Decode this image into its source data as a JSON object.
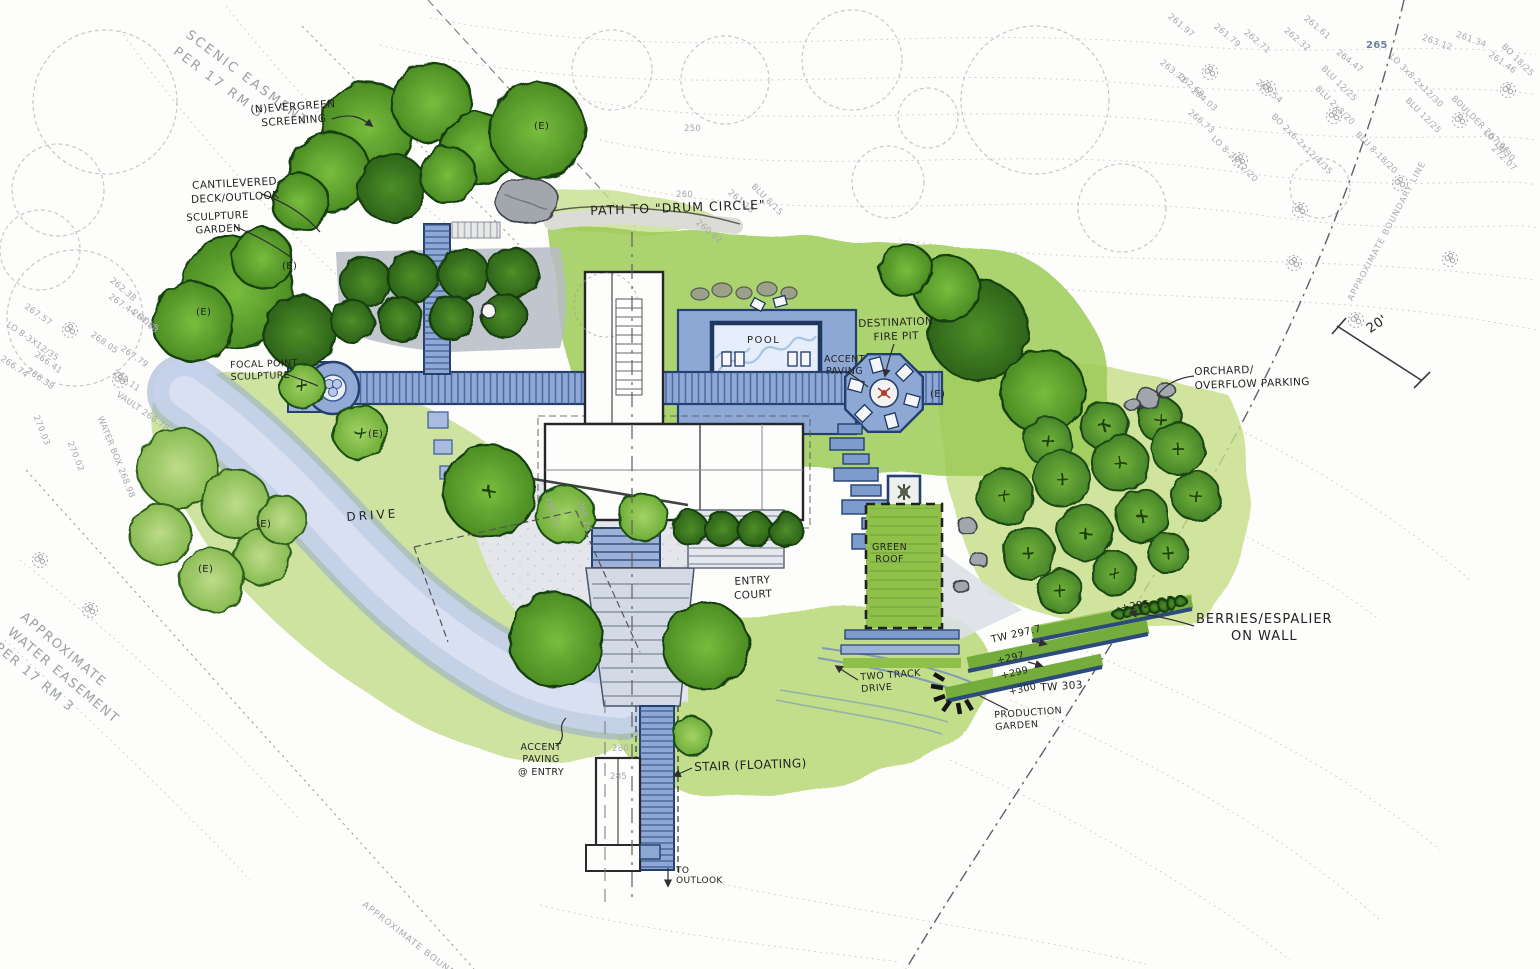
{
  "meta": {
    "drawing_type": "residential landscape site plan, hand-rendered",
    "scale_label": "20'"
  },
  "colors": {
    "paper": "#fdfdfb",
    "canopy_dark": "#2f6b25",
    "canopy_medium": "#57972c",
    "canopy_light": "#7ab344",
    "lawn": "#9ccb55",
    "groundcover": "#c6de8e",
    "paving_blue": "#8ea8d6",
    "drive_blue": "#c7d3ec",
    "pool_water": "#e5eefa",
    "outline_blue": "#23406e",
    "survey_gray": "#a6a9ad",
    "ink": "#232323",
    "fire_accent": "#b43a2e"
  },
  "labels": {
    "scenic_easement": "SCENIC EASMENT\nPER 17 RM 3",
    "evergreen_screening": "(N)EVERGREEN\nSCREENING",
    "cantilevered_deck": "CANTILEVERED\nDECK/OUTLOOK",
    "sculpture_garden": "SCULPTURE\nGARDEN",
    "path_drum_circle": "PATH TO \"DRUM CIRCLE\"",
    "pool": "POOL",
    "destination_fire_pit": "DESTINATION\nFIRE PIT",
    "accent_paving": "ACCENT\nPAVING",
    "orchard_overflow": "ORCHARD/\nOVERFLOW PARKING",
    "focal_point": "FOCAL POINT\nSCULPTURE",
    "drive": "DRIVE",
    "entry_court": "ENTRY\nCOURT",
    "green_roof": "GREEN\nROOF",
    "berries_espalier": "BERRIES/ESPALIER\nON WALL",
    "production_garden": "PRODUCTION\nGARDEN",
    "two_track_drive": "TWO TRACK\nDRIVE",
    "accent_paving_entry": "ACCENT\nPAVING\n@ ENTRY",
    "stair_floating": "STAIR (FLOATING)",
    "to_outlook": "TO\nOUTLOOK",
    "water_easement": "APPROXIMATE\nWATER EASEMENT\nPER 17 RM 3",
    "boundary_line": "APPROXIMATE BOUNDARY LINE",
    "boundary": "APPROXIMATE BOUNDARY",
    "scale": "20'",
    "existing_tree_tag": "(E)",
    "elevations": {
      "p295": "+295",
      "tw297": "TW 297.7",
      "p297": "+297",
      "p299": "+299",
      "p300": "+300",
      "tw303": "TW 303"
    }
  },
  "survey_marks": [
    {
      "text": "261.97",
      "x": 1172,
      "y": 12,
      "rot": 40
    },
    {
      "text": "261.79",
      "x": 1218,
      "y": 22,
      "rot": 40
    },
    {
      "text": "262.71",
      "x": 1248,
      "y": 28,
      "rot": 40
    },
    {
      "text": "262.32",
      "x": 1288,
      "y": 26,
      "rot": 40
    },
    {
      "text": "261.61",
      "x": 1308,
      "y": 14,
      "rot": 40
    },
    {
      "text": "264.47",
      "x": 1340,
      "y": 48,
      "rot": 38
    },
    {
      "text": "265",
      "x": 1366,
      "y": 40,
      "rot": 0,
      "cls": "em"
    },
    {
      "text": "263.12",
      "x": 1424,
      "y": 33,
      "rot": 20
    },
    {
      "text": "261.34",
      "x": 1458,
      "y": 30,
      "rot": 20
    },
    {
      "text": "261.46",
      "x": 1492,
      "y": 50,
      "rot": 35
    },
    {
      "text": "BO 18/25",
      "x": 1506,
      "y": 42,
      "rot": 45
    },
    {
      "text": "262.69",
      "x": 1182,
      "y": 72,
      "rot": 40
    },
    {
      "text": "263.71",
      "x": 1164,
      "y": 58,
      "rot": 40
    },
    {
      "text": "265.54",
      "x": 1260,
      "y": 78,
      "rot": 40
    },
    {
      "text": "264.03",
      "x": 1195,
      "y": 86,
      "rot": 40
    },
    {
      "text": "266.73",
      "x": 1192,
      "y": 108,
      "rot": 40
    },
    {
      "text": "BLU 12/25",
      "x": 1326,
      "y": 64,
      "rot": 45
    },
    {
      "text": "BLU 2x8/20",
      "x": 1320,
      "y": 84,
      "rot": 45
    },
    {
      "text": "LO 3x8-2x12/30",
      "x": 1394,
      "y": 52,
      "rot": 45
    },
    {
      "text": "BLU 12/25",
      "x": 1410,
      "y": 96,
      "rot": 45
    },
    {
      "text": "BOULDER 267.96",
      "x": 1456,
      "y": 94,
      "rot": 45
    },
    {
      "text": "BO 2x6-2x12/4/35",
      "x": 1276,
      "y": 112,
      "rot": 45
    },
    {
      "text": "BLU 8-18/20",
      "x": 1360,
      "y": 130,
      "rot": 45
    },
    {
      "text": "LO 19/30",
      "x": 1488,
      "y": 128,
      "rot": 45
    },
    {
      "text": "272.07",
      "x": 1496,
      "y": 144,
      "rot": 45
    },
    {
      "text": "LO 8-2X12/20",
      "x": 1216,
      "y": 134,
      "rot": 45
    },
    {
      "text": "267.57",
      "x": 28,
      "y": 302,
      "rot": 35
    },
    {
      "text": "LO 8-3X12/35",
      "x": 10,
      "y": 320,
      "rot": 35
    },
    {
      "text": "266.74",
      "x": 4,
      "y": 354,
      "rot": 35
    },
    {
      "text": "266.41",
      "x": 38,
      "y": 350,
      "rot": 35
    },
    {
      "text": "266.38",
      "x": 30,
      "y": 366,
      "rot": 35
    },
    {
      "text": "267.44 HOLE",
      "x": 112,
      "y": 292,
      "rot": 35
    },
    {
      "text": "267.83",
      "x": 136,
      "y": 308,
      "rot": 40
    },
    {
      "text": "262.38",
      "x": 114,
      "y": 276,
      "rot": 40
    },
    {
      "text": "268.05",
      "x": 94,
      "y": 330,
      "rot": 35
    },
    {
      "text": "267.79",
      "x": 124,
      "y": 344,
      "rot": 35
    },
    {
      "text": "268.11",
      "x": 116,
      "y": 368,
      "rot": 35
    },
    {
      "text": "VAULT 268.78",
      "x": 120,
      "y": 390,
      "rot": 35
    },
    {
      "text": "WATER BOX 268.98",
      "x": 104,
      "y": 415,
      "rot": 68
    },
    {
      "text": "270.03",
      "x": 40,
      "y": 414,
      "rot": 68
    },
    {
      "text": "270.02",
      "x": 74,
      "y": 440,
      "rot": 68
    },
    {
      "text": "260",
      "x": 676,
      "y": 190,
      "rot": 0
    },
    {
      "text": "250",
      "x": 684,
      "y": 124,
      "rot": 0
    },
    {
      "text": "261.18",
      "x": 732,
      "y": 188,
      "rot": 40
    },
    {
      "text": "BLU 8/15",
      "x": 756,
      "y": 182,
      "rot": 45
    },
    {
      "text": "260.82",
      "x": 700,
      "y": 218,
      "rot": 40
    },
    {
      "text": "266.21",
      "x": 552,
      "y": 496,
      "rot": 72
    },
    {
      "text": "266.24",
      "x": 584,
      "y": 500,
      "rot": 72
    },
    {
      "text": "280",
      "x": 612,
      "y": 744,
      "rot": 0
    },
    {
      "text": "285",
      "x": 610,
      "y": 772,
      "rot": 0
    }
  ]
}
